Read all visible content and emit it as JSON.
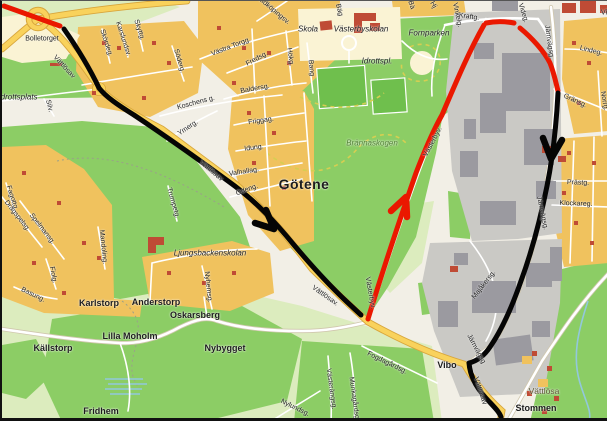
{
  "colors": {
    "bg": "#f2efe6",
    "field": "#dcecbe",
    "forest": "#8ccd65",
    "pitch": "#6fbf4d",
    "residential": "#f0c25e",
    "civic": "#faf3d4",
    "industrial": "#cac9c5",
    "building_gray": "#9b9aa0",
    "building_red": "#bf4b35",
    "road_white": "#ffffff",
    "road_casing": "#d0c7ae",
    "road_yellow": "#f9d25c",
    "yellow_casing": "#d8a63c",
    "route_black": "#050505",
    "route_red": "#ea1800",
    "water": "#92c8dc",
    "dashed_path": "#d6ce52",
    "label": "#1c1c1c",
    "nature_label": "#4b7d2d"
  },
  "labels": {
    "places": {
      "gotene": "Götene",
      "bolletorget": "Bolletorget",
      "karlstorp": "Karlstorp",
      "anderstorp": "Anderstorp",
      "oskarsberg": "Oskarsberg",
      "lilla_moholm": "Lilla Moholm",
      "kallstorp": "Källstorp",
      "nybygget": "Nybygget",
      "fridhem": "Fridhem",
      "vibo": "Vibo",
      "vattlosa": "Vättlösa",
      "stommen": "Stommen"
    },
    "pois": {
      "idrottsplats": "Idrottsplats",
      "idrottspl": "Idrottspl.",
      "skola": "Skola",
      "vasterbyskolan": "Västerbyskolan",
      "fornparken": "Fornparken",
      "brannaskogen": "Brännaskogen",
      "ljungsbackenskolan": "Ljungsbackenskolan"
    },
    "streets": {
      "vattlosav": "Vättlösav",
      "vattlosav_dot": "Vättlösav.",
      "vasterbyv": "Västerbyv.",
      "jarnvagsg": "Järnvägsg.",
      "jarnvagsg_plain": "Järnvägsg",
      "kraftg": "Kraftg.",
      "videg": "Videg.",
      "lindeg": "Lindeg.",
      "gransg": "Gränsg.",
      "norrg": "Norrg.",
      "prastg": "Prästg.",
      "klockareg": "Klockareg.",
      "vinkelg": "Vinkelg.",
      "vastra_torgg": "Västra Torgg.",
      "fredsg": "Fredsg.",
      "hokg": "Hökg.",
      "bang": "Bang",
      "baldersg": "Baldersg.",
      "koschens_g": "Koschens g.",
      "ymerg": "Ymerg.",
      "friggag": "Friggag.",
      "idung": "Idung.",
      "valhallag": "Valhallag.",
      "odeng": "Odeng.",
      "trumpetg": "Trumpetg.",
      "spelmansg": "Spelmansg.",
      "dragspelsg": "Dragspelsg.",
      "fagottg": "Fagottg.",
      "mandoling": "Mandoling.",
      "fiolg": "Fiolg.",
      "basung": "Basung.",
      "nyhemsg": "Nyhemsg.",
      "majakersg": "Majåkersg.",
      "fogdagardsg": "Fogdagårdsg.",
      "vasterangsg": "Västerängsg.",
      "munkagardsg": "Munkagårdsg.",
      "nylundsg": "Nylundsg.",
      "lidkopingsv": "Lidköpingsv.",
      "soderg": "Söderg.",
      "silv": "Silv.",
      "skordeg": "Skördeg.",
      "karslundsv": "Karslundsv.",
      "skyttg": "Skyttg."
    },
    "partials": {
      "bag": "Bäg",
      "ba": "Bä",
      "hj": "Hj",
      "vi": "Vi"
    }
  }
}
